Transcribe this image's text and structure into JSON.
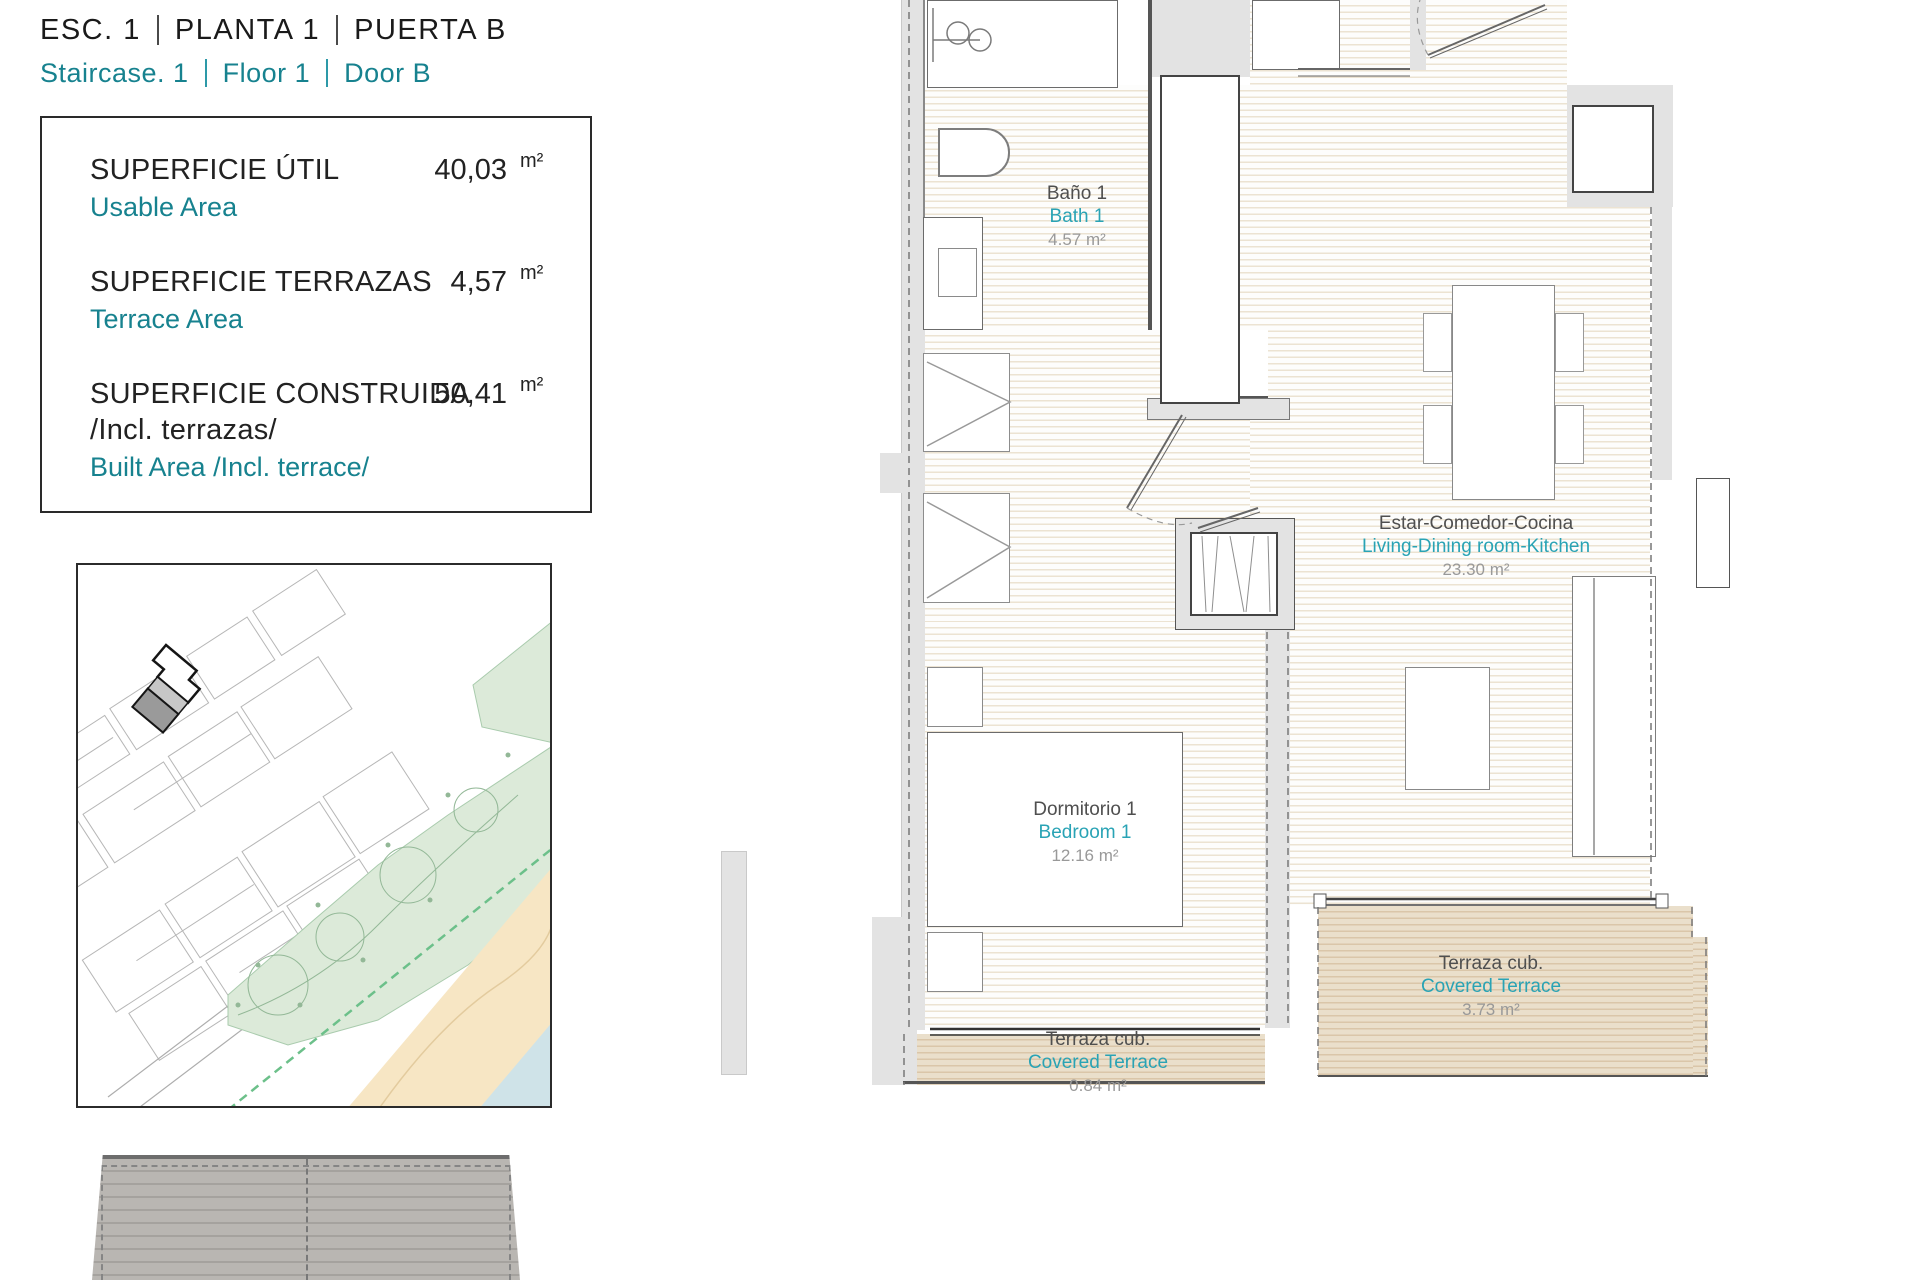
{
  "header": {
    "title_parts": [
      "ESC.  1",
      "PLANTA   1",
      "PUERTA B"
    ],
    "subtitle_parts": [
      "Staircase.  1",
      "Floor   1",
      "Door B"
    ]
  },
  "area_box": {
    "rows": [
      {
        "label": "SUPERFICIE ÚTIL",
        "label_extra": "",
        "sublabel": "Usable Area",
        "value": "40,03",
        "unit": "m²"
      },
      {
        "label": "SUPERFICIE TERRAZAS",
        "label_extra": "",
        "sublabel": "Terrace Area",
        "value": "4,57",
        "unit": "m²"
      },
      {
        "label": "SUPERFICIE CONSTRUIDA",
        "label_extra": "/Incl. terrazas/",
        "sublabel": "Built Area /Incl. terrace/",
        "value": "50,41",
        "unit": "m²"
      }
    ]
  },
  "floor_plan": {
    "rooms": [
      {
        "name_es": "Baño 1",
        "name_en": "Bath 1",
        "area": "4.57 m²"
      },
      {
        "name_es": "Estar-Comedor-Cocina",
        "name_en": "Living-Dining room-Kitchen",
        "area": "23.30 m²"
      },
      {
        "name_es": "Dormitorio 1",
        "name_en": "Bedroom 1",
        "area": "12.16 m²"
      },
      {
        "name_es": "Terraza cub.",
        "name_en": "Covered Terrace",
        "area": "3.73 m²"
      },
      {
        "name_es": "Terraza cub.",
        "name_en": "Covered Terrace",
        "area": "0.84 m²"
      }
    ]
  },
  "colors": {
    "teal_header": "#17828f",
    "teal_plan": "#29a3b5",
    "label_gray": "#4f4f4f",
    "area_gray": "#999999",
    "wall_gray": "#e3e3e3",
    "terrace_tan": "#dac6a9",
    "map_green": "#dcead9",
    "map_sand": "#f7e6c4",
    "map_water": "#cfe3e8",
    "highlight_building_gray": "#9a9a9a"
  }
}
